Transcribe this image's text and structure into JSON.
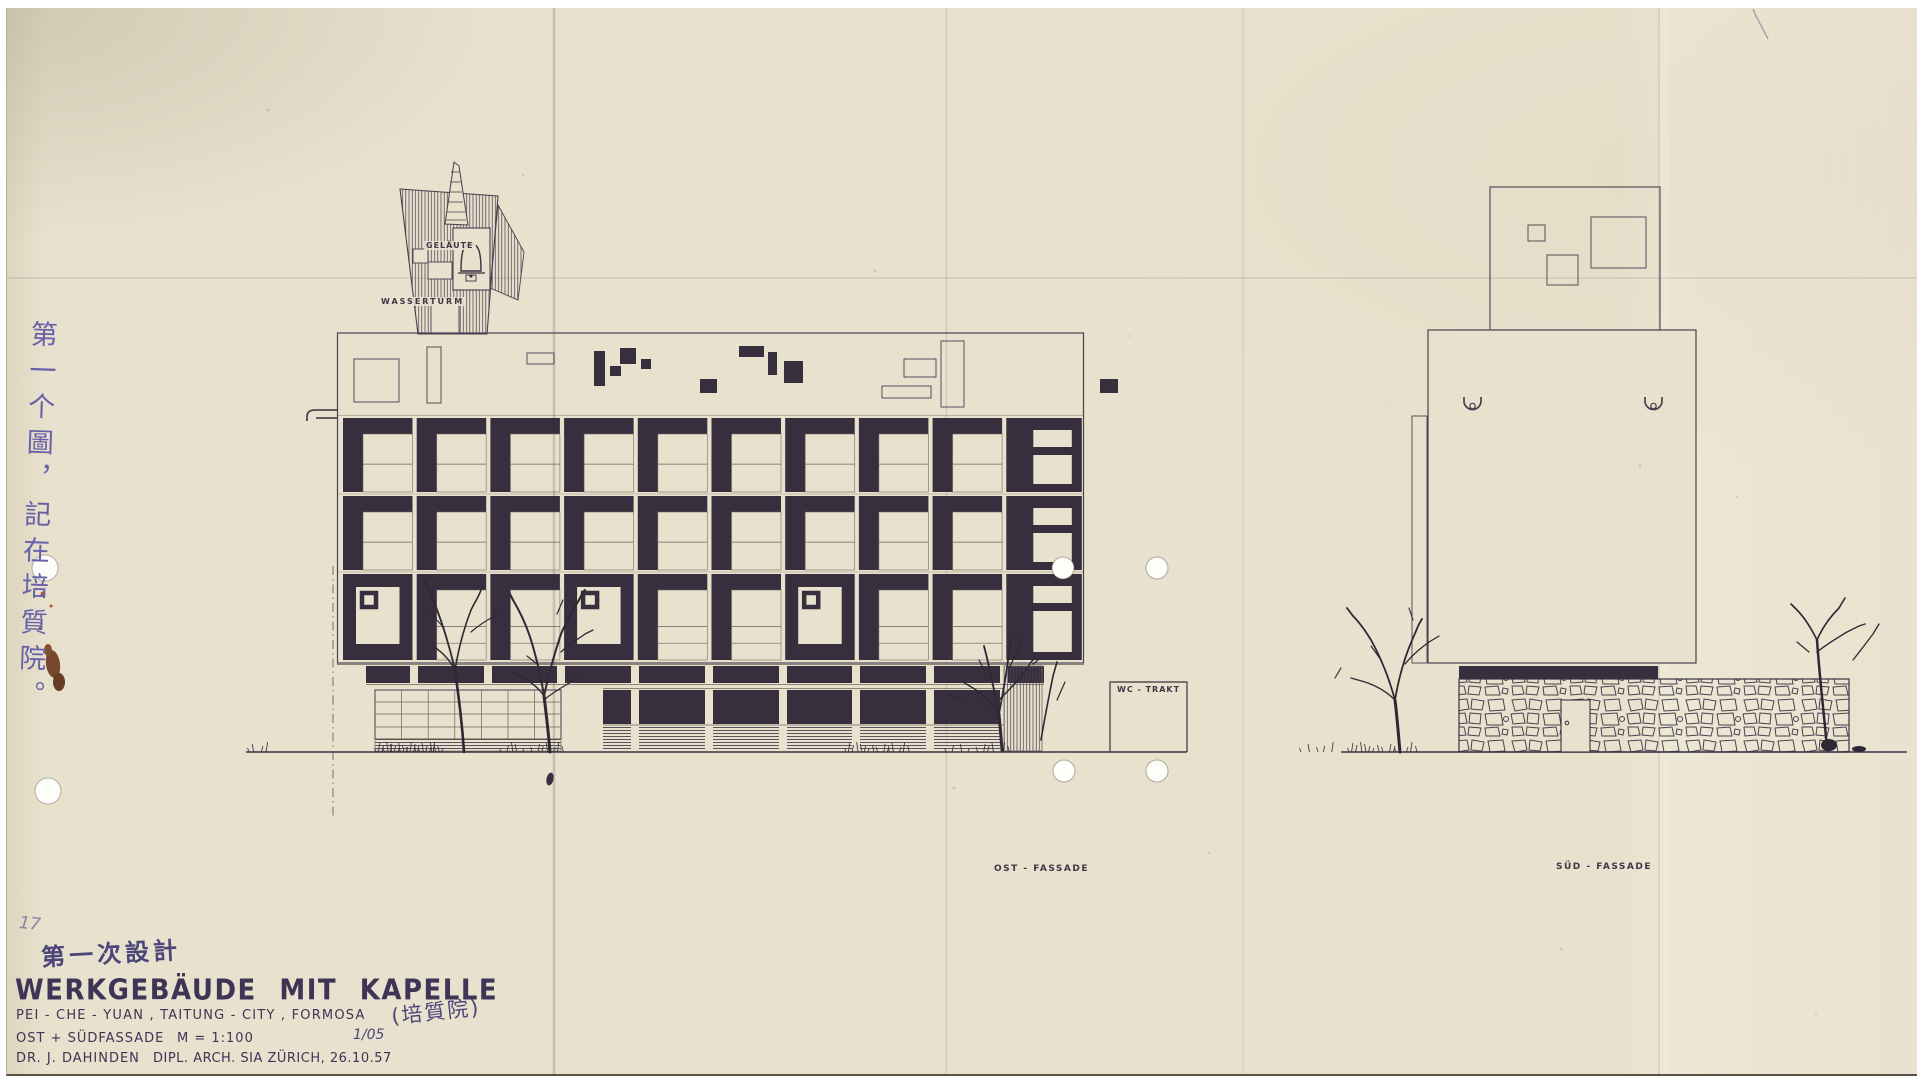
{
  "sheet": {
    "annotations": {
      "bell_label": "GELÄUTE",
      "water_tower_label": "WASSERTURM",
      "wc_label": "WC - TRAKT",
      "east_facade_label": "OST - FASSADE",
      "south_facade_label": "SÜD - FASSADE"
    },
    "handwriting": {
      "pencil_number": "17",
      "side_note_vertical": "第一个圖，記在培質院。",
      "design_phase_note": "第一次設計",
      "name_chinese": "(培質院)"
    },
    "title_block": {
      "title": "WERKGEBÄUDE  MIT  KAPELLE",
      "location": "PEI - CHE - YUAN ,  TAITUNG - CITY ,  FORMOSA",
      "drawing_name": "OST + SÜDFASSADE",
      "scale": "M = 1:100",
      "sheet_number": "1/05",
      "architect": "DR. J. DAHINDEN",
      "credentials": "DIPL. ARCH. SIA  ZÜRICH, 26.10.57"
    },
    "colors": {
      "paper": "#e8e1cd",
      "ink_fill": "#382f3e",
      "ink_line": "#49404f",
      "handwriting_blue": "#6661a8",
      "stain_brown": "#6e3b1e"
    }
  }
}
